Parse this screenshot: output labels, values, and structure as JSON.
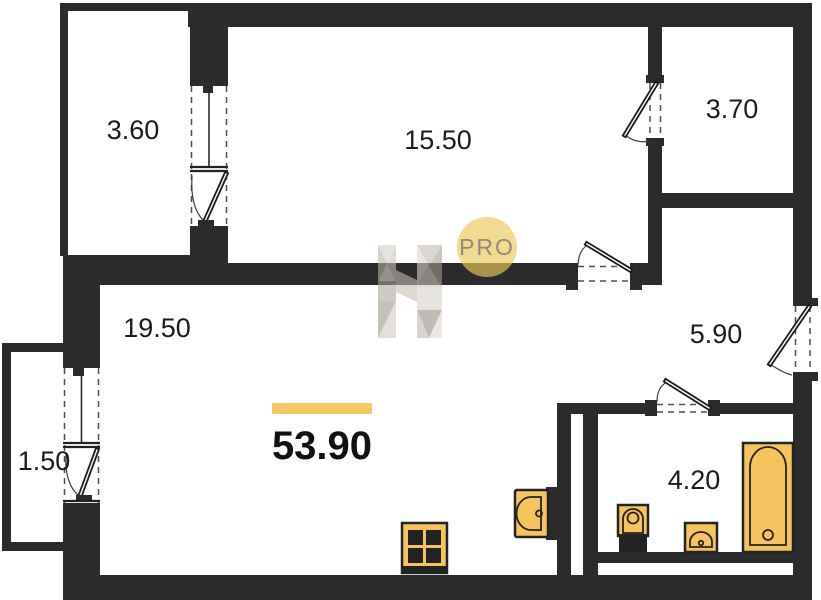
{
  "plan": {
    "total_area": "53.90",
    "rooms": [
      {
        "name": "balcony-top",
        "area": "3.60"
      },
      {
        "name": "bedroom",
        "area": "15.50"
      },
      {
        "name": "wardrobe",
        "area": "3.70"
      },
      {
        "name": "living-kitchen",
        "area": "19.50"
      },
      {
        "name": "hallway",
        "area": "5.90"
      },
      {
        "name": "balcony-left",
        "area": "1.50"
      },
      {
        "name": "bathroom",
        "area": "4.20"
      }
    ],
    "watermark": {
      "badge_text": "PRO"
    },
    "fixtures": [
      "stove",
      "kitchen-sink",
      "toilet",
      "washbasin",
      "bathtub"
    ],
    "colors": {
      "wall": "#2b2b2b",
      "fixture_fill": "#F6C45F",
      "accent_bar": "#F2C862",
      "badge_fill": "#EAC759",
      "badge_text_color": "#8B8274"
    }
  }
}
